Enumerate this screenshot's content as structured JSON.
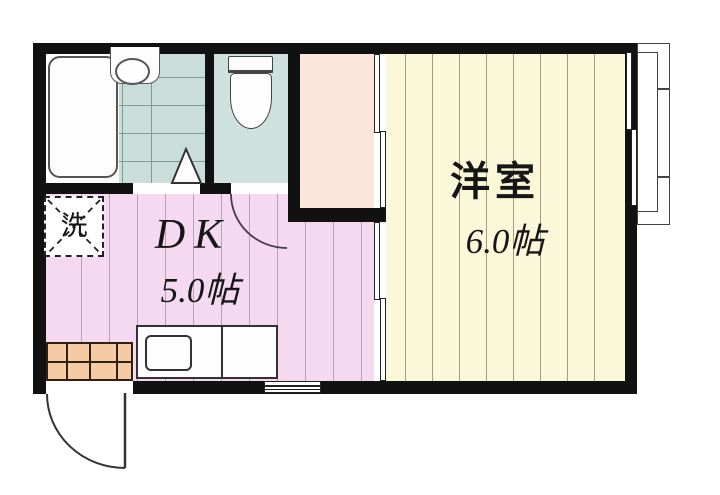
{
  "plan": {
    "rooms": {
      "dk": {
        "label": "DK",
        "size": "5.0帖"
      },
      "western_room": {
        "label": "洋室",
        "size": "6.0帖"
      },
      "laundry_space": {
        "label": "洗"
      }
    },
    "fixtures": [
      "bathtub",
      "washbasin",
      "bathroom-tiled-floor",
      "toilet",
      "kitchen-counter-grid",
      "kitchen-sink-unit",
      "washing-machine-space",
      "entrance-swing-door",
      "toilet-swing-door",
      "bathroom-folding-door",
      "sliding-door-closet",
      "sliding-door-dk-western",
      "balcony",
      "balcony-sliding-window",
      "kitchen-window"
    ],
    "colors": {
      "wall": "#111111",
      "dk_floor": "#f5d9f1",
      "dk_stripe": "#b9a2b8",
      "western_floor": "#fbf8d9",
      "western_stripe": "#9f9f86",
      "closet_floor": "#fae6db",
      "bath_tile": "#c9ded9",
      "bath_tile_line": "#7f9b95",
      "toilet_floor": "#cfe1dd",
      "counter_fill": "#f6cba3",
      "counter_line": "#2e2013"
    }
  }
}
